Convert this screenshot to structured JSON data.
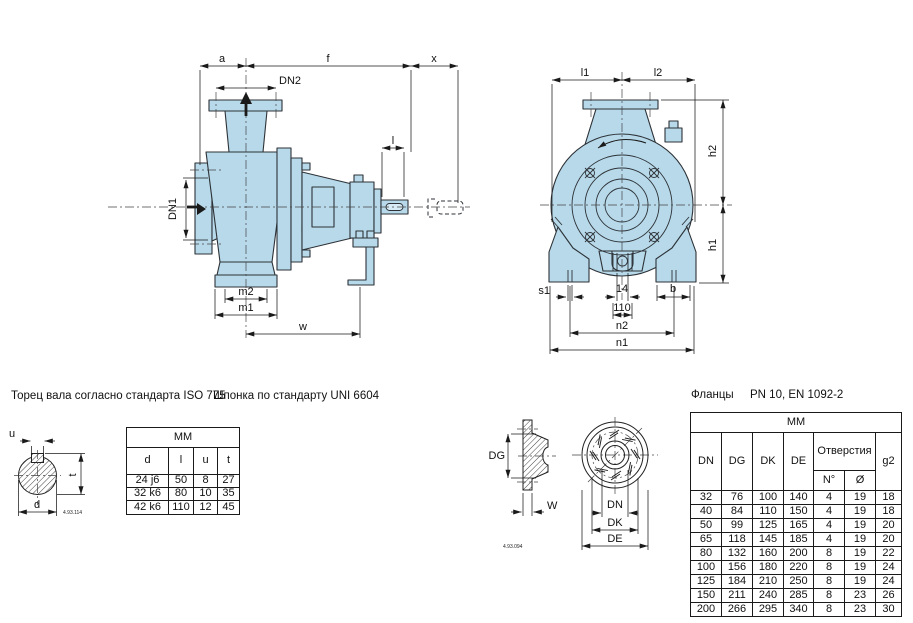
{
  "labels": {
    "a": "a",
    "f": "f",
    "x": "x",
    "dn2": "DN2",
    "dn1": "DN1",
    "l": "l",
    "m2": "m2",
    "m1": "m1",
    "w": "w",
    "l1": "l1",
    "l2": "l2",
    "h2": "h2",
    "h1": "h1",
    "s1": "s1",
    "dim14": "14",
    "dim110": "110",
    "b": "b",
    "n2": "n2",
    "n1": "n1",
    "u": "u",
    "t": "t",
    "d": "d",
    "dg": "DG",
    "wf": "W",
    "dn": "DN",
    "dk": "DK",
    "de": "DE"
  },
  "codes": {
    "shaft": "4.93.114",
    "flange": "4.93.094"
  },
  "notes": {
    "shaft_note": "Торец вала согласно стандарта ISO 775",
    "key_note": "Шпонка по стандарту UNI 6604"
  },
  "shaft_table": {
    "unit_header": "MM",
    "columns": [
      "d",
      "l",
      "u",
      "t"
    ],
    "rows": [
      [
        "24 j6",
        "50",
        "8",
        "27"
      ],
      [
        "32 k6",
        "80",
        "10",
        "35"
      ],
      [
        "42 k6",
        "110",
        "12",
        "45"
      ]
    ]
  },
  "flange_section": {
    "title": "Фланцы",
    "subtitle": "PN 10, EN 1092-2",
    "table": {
      "unit_header": "MM",
      "columns": [
        "DN",
        "DG",
        "DK",
        "DE",
        "Отверстия",
        "g2"
      ],
      "holes_sub_columns": [
        "N°",
        "Ø"
      ],
      "rows": [
        [
          "32",
          "76",
          "100",
          "140",
          "4",
          "19",
          "18"
        ],
        [
          "40",
          "84",
          "110",
          "150",
          "4",
          "19",
          "18"
        ],
        [
          "50",
          "99",
          "125",
          "165",
          "4",
          "19",
          "20"
        ],
        [
          "65",
          "118",
          "145",
          "185",
          "4",
          "19",
          "20"
        ],
        [
          "80",
          "132",
          "160",
          "200",
          "8",
          "19",
          "22"
        ],
        [
          "100",
          "156",
          "180",
          "220",
          "8",
          "19",
          "24"
        ],
        [
          "125",
          "184",
          "210",
          "250",
          "8",
          "19",
          "24"
        ],
        [
          "150",
          "211",
          "240",
          "285",
          "8",
          "23",
          "26"
        ],
        [
          "200",
          "266",
          "295",
          "340",
          "8",
          "23",
          "30"
        ]
      ]
    }
  },
  "colors": {
    "pump_fill": "#b7d9ea",
    "outline": "#2d3237",
    "dim_line": "#1a1a1a"
  }
}
